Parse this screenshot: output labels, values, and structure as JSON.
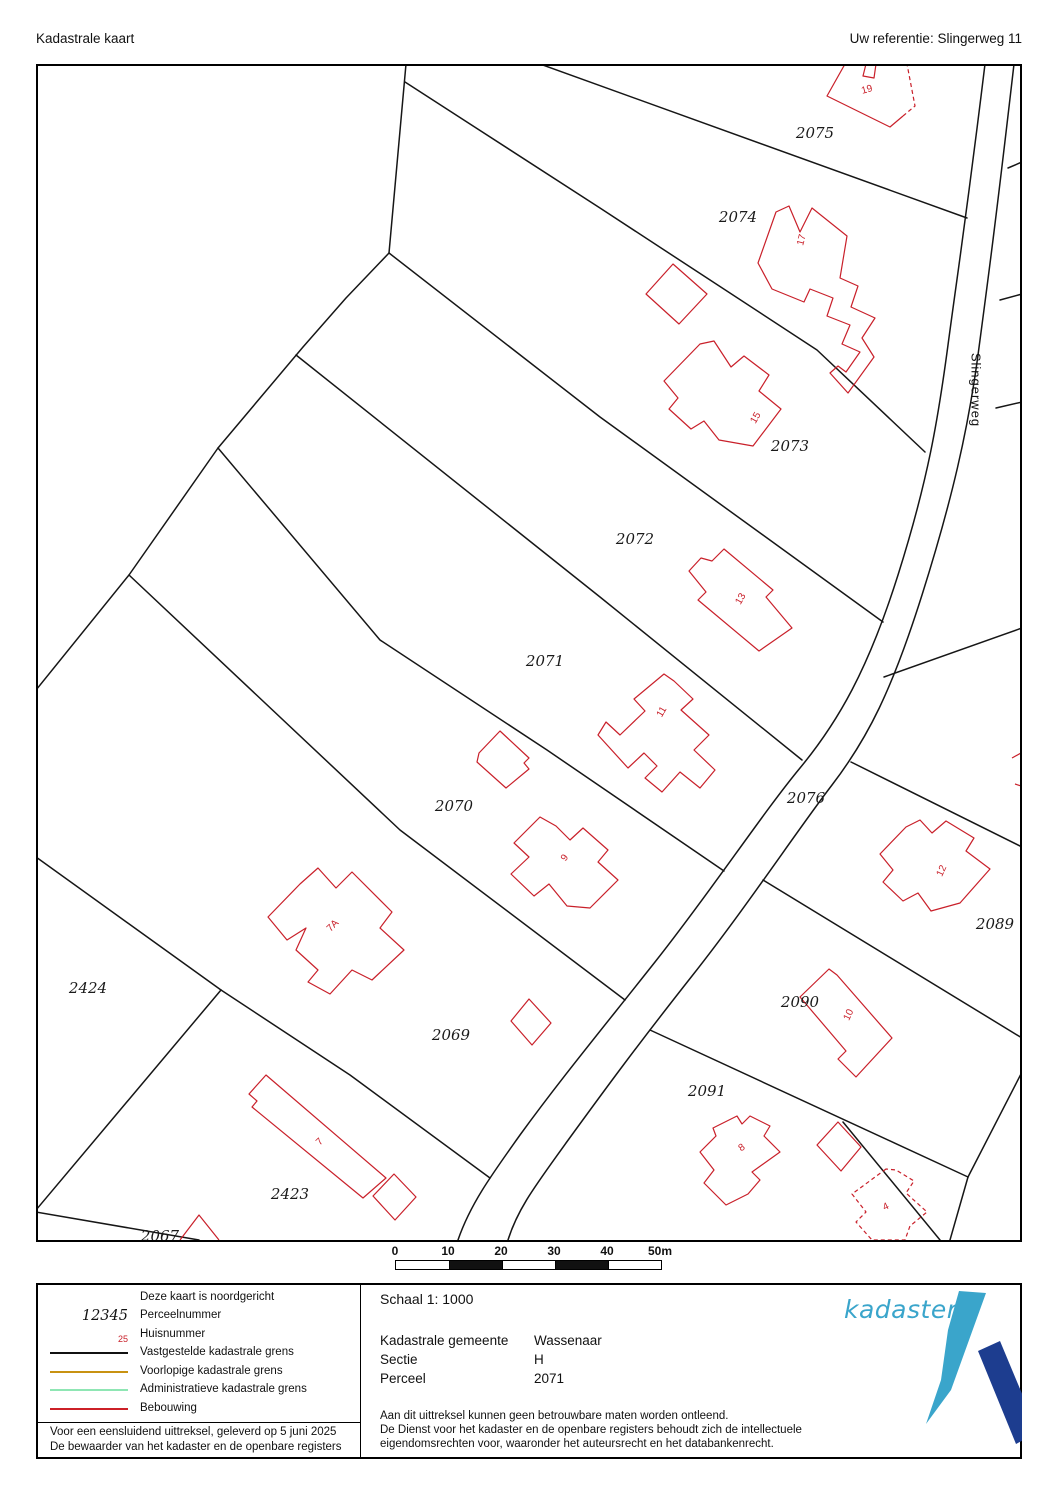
{
  "header": {
    "title": "Kadastrale kaart",
    "reference": "Uw referentie: Slingerweg 11"
  },
  "map": {
    "road_label": "Slingerweg",
    "parcels": [
      {
        "number": "2075",
        "x": 815,
        "y": 133
      },
      {
        "number": "2074",
        "x": 738,
        "y": 217
      },
      {
        "number": "2073",
        "x": 790,
        "y": 446
      },
      {
        "number": "2072",
        "x": 635,
        "y": 539
      },
      {
        "number": "2071",
        "x": 545,
        "y": 661
      },
      {
        "number": "2070",
        "x": 454,
        "y": 806
      },
      {
        "number": "2076",
        "x": 806,
        "y": 798
      },
      {
        "number": "2089",
        "x": 995,
        "y": 924
      },
      {
        "number": "2090",
        "x": 800,
        "y": 1002
      },
      {
        "number": "2091",
        "x": 707,
        "y": 1091
      },
      {
        "number": "2424",
        "x": 88,
        "y": 988
      },
      {
        "number": "2069",
        "x": 451,
        "y": 1035
      },
      {
        "number": "2423",
        "x": 290,
        "y": 1194
      },
      {
        "number": "2067",
        "x": 160,
        "y": 1236
      }
    ],
    "houses": [
      {
        "number": "19",
        "x": 867,
        "y": 90,
        "rot": -15
      },
      {
        "number": "17",
        "x": 802,
        "y": 240,
        "rot": -75
      },
      {
        "number": "15",
        "x": 756,
        "y": 418,
        "rot": -60
      },
      {
        "number": "13",
        "x": 741,
        "y": 599,
        "rot": -60
      },
      {
        "number": "11",
        "x": 662,
        "y": 712,
        "rot": -60
      },
      {
        "number": "9",
        "x": 565,
        "y": 858,
        "rot": -55
      },
      {
        "number": "7A",
        "x": 333,
        "y": 926,
        "rot": -45
      },
      {
        "number": "7",
        "x": 320,
        "y": 1142,
        "rot": -45
      },
      {
        "number": "12",
        "x": 942,
        "y": 871,
        "rot": -65
      },
      {
        "number": "10",
        "x": 849,
        "y": 1015,
        "rot": -65
      },
      {
        "number": "8",
        "x": 742,
        "y": 1148,
        "rot": -35
      },
      {
        "number": "4",
        "x": 886,
        "y": 1207,
        "rot": -25
      }
    ]
  },
  "scalebar": {
    "ticks": [
      "0",
      "10",
      "20",
      "30",
      "40",
      "50m"
    ],
    "segment_px": 53,
    "colors": [
      "#ffffff",
      "#111111",
      "#ffffff",
      "#111111",
      "#ffffff"
    ]
  },
  "legend": {
    "north_note": "Deze kaart is noordgericht",
    "items": [
      {
        "type": "text-parcel",
        "symbol": "12345",
        "label": "Perceelnummer"
      },
      {
        "type": "text-house",
        "symbol": "25",
        "label": "Huisnummer"
      },
      {
        "type": "line",
        "color": "#111111",
        "label": "Vastgestelde kadastrale grens"
      },
      {
        "type": "line",
        "color": "#c89211",
        "label": "Voorlopige kadastrale grens"
      },
      {
        "type": "line",
        "color": "#8fe6b4",
        "label": "Administratieve kadastrale grens"
      },
      {
        "type": "line",
        "color": "#cc2027",
        "label": "Bebouwing"
      }
    ],
    "footer_line1": "Voor een eensluidend uittreksel, geleverd op 5 juni 2025",
    "footer_line2": "De bewaarder van het kadaster en de openbare registers"
  },
  "details": {
    "schaal": "Schaal 1: 1000",
    "rows": [
      {
        "label": "Kadastrale gemeente",
        "value": "Wassenaar"
      },
      {
        "label": "Sectie",
        "value": "H"
      },
      {
        "label": "Perceel",
        "value": "2071"
      }
    ],
    "disclaimer": [
      "Aan dit uittreksel kunnen geen betrouwbare maten worden ontleend.",
      "De Dienst voor het kadaster en de openbare registers behoudt zich de intellectuele",
      "eigendomsrechten voor, waaronder het auteursrecht en het databankenrecht."
    ]
  },
  "logo": {
    "text": "kadaster",
    "light_blue": "#3aa5cb",
    "dark_blue": "#1d3d8f"
  }
}
